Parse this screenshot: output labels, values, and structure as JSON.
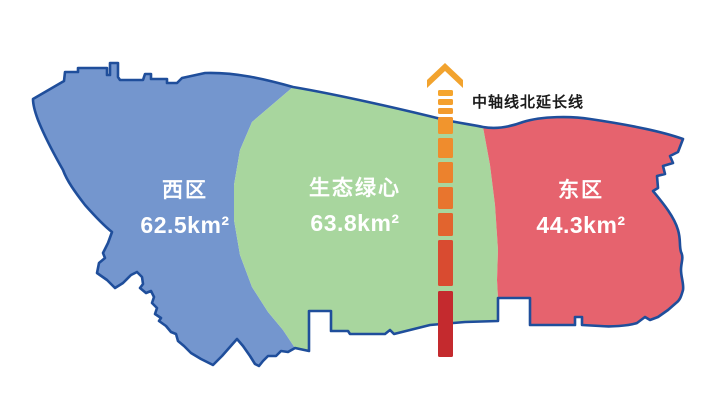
{
  "map": {
    "outline_color": "#1F4E9B",
    "background": "#FFFFFF"
  },
  "regions": [
    {
      "id": "west",
      "name": "西区",
      "area": "62.5km²",
      "fill": "#7496CE",
      "text_color": "#FFFFFF"
    },
    {
      "id": "green-heart",
      "name": "生态绿心",
      "area": "63.8km²",
      "fill": "#A8D69E",
      "text_color": "#FFFFFF"
    },
    {
      "id": "east",
      "name": "东区",
      "area": "44.3km²",
      "fill": "#E6636E",
      "text_color": "#FFFFFF"
    }
  ],
  "axis": {
    "label": "中轴线北延长线",
    "label_color": "#1A1A1A",
    "arrow_color": "#F2A32E",
    "dash_colors": [
      "#F5A52D",
      "#F4A02D",
      "#F39B2D",
      "#F1952D",
      "#EF8C2D",
      "#EC822D",
      "#E8752E",
      "#E2642E",
      "#D94B30",
      "#C42A2E"
    ]
  }
}
